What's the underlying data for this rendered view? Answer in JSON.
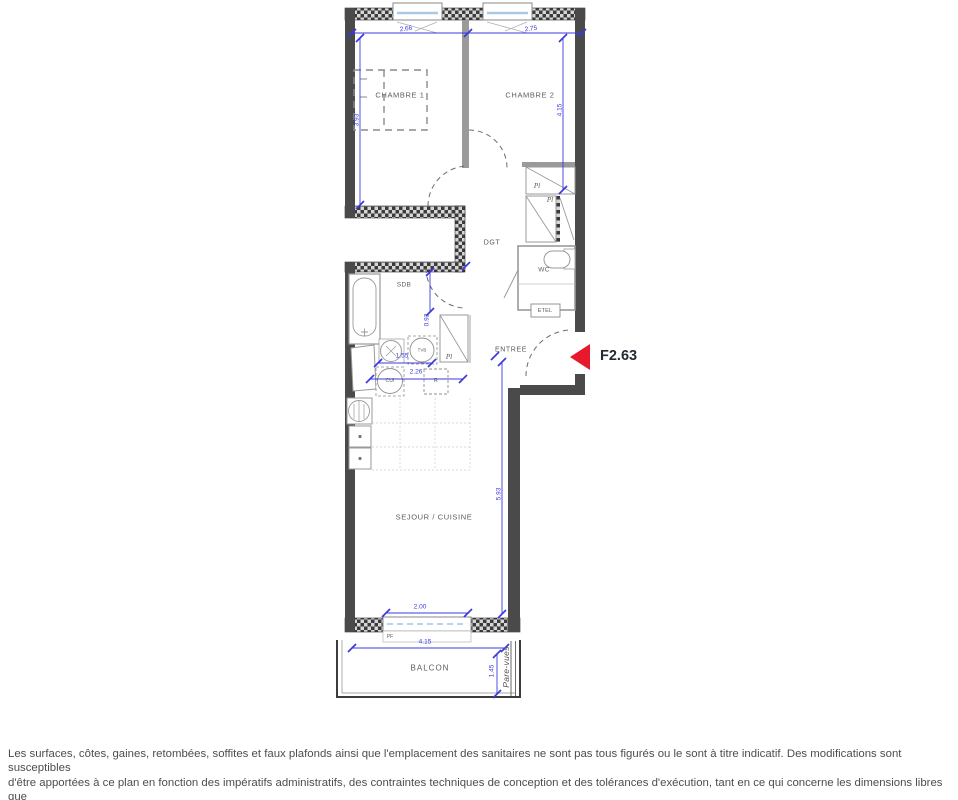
{
  "unit": {
    "label": "F2.63"
  },
  "rooms": {
    "chambre1": "CHAMBRE 1",
    "chambre2": "CHAMBRE 2",
    "dgt": "DGT",
    "wc": "WC",
    "sdb": "SDB",
    "entree": "ENTREE",
    "sejour": "SEJOUR / CUISINE",
    "balcon": "BALCON"
  },
  "labels": {
    "pl": "Pl",
    "etel": "ETEL",
    "pf": "PF",
    "tvb": "TVB",
    "cui": "CUI",
    "fridge": "R",
    "pare_vues": "Pare-vues"
  },
  "dims": {
    "top_left": "2.66",
    "top_right": "2.75",
    "ch1_height": "3.93",
    "ch2_height": "4.15",
    "sdb_door": "0.92",
    "kitchen_small": "1.55",
    "kitchen_large": "2.26",
    "sejour_height": "5.93",
    "pf_width": "2.00",
    "balcony_width": "4.15",
    "balcony_depth": "1.45"
  },
  "colors": {
    "wall_dark": "#4a4a4a",
    "wall_hatch_light": "#d6d6d6",
    "partition_gray": "#9a9a9a",
    "dimension_blue": "#3a3ae0",
    "entry_arrow_red": "#e8192c",
    "window_glass_blue": "#a9c9e9",
    "label_gray": "#5c5c5c",
    "footer_gray": "#4d4d4d"
  },
  "footer": {
    "line1": "Les surfaces, côtes, gaines, retombées, soffites et faux plafonds ainsi que l'emplacement des sanitaires ne sont pas tous figurés ou le sont à titre indicatif. Des modifications sont susceptibles",
    "line2": "d'être apportées à ce plan en fonction des impératifs administratifs, des contraintes techniques de conception et des tolérances d'exécution, tant en ce qui concerne les dimensions libres que",
    "line3": "les équipements et les réseaux divers, les appareillages sanitaires et électriques. Seuls seront fournis les équipements figurant sur le descriptif en annexe de l'acte de vente."
  }
}
